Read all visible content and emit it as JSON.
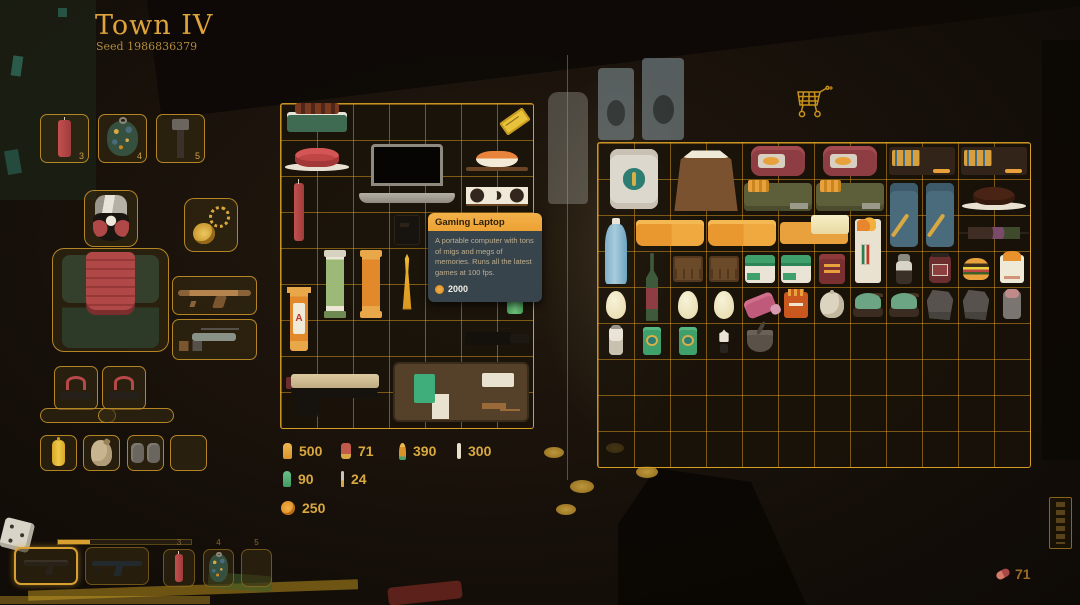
{
  "header": {
    "title": "Town IV",
    "seed": "Seed 1986836379"
  },
  "tooltip": {
    "title": "Gaming Laptop",
    "description": "A portable computer with tons of migs and megs of memories. Runs all the latest games at 100 fps.",
    "price": "2000"
  },
  "ammo": [
    {
      "icon": "pistol-round",
      "count": "500"
    },
    {
      "icon": "shotgun-shell",
      "count": "71"
    },
    {
      "icon": "rifle-round",
      "count": "390"
    },
    {
      "icon": "thin-round",
      "count": "300"
    },
    {
      "icon": "smg-green",
      "count": "90"
    },
    {
      "icon": "needle",
      "count": "24"
    }
  ],
  "coins": {
    "count": "250"
  },
  "pills": {
    "count": "71"
  },
  "quickslots": [
    {
      "num": "3",
      "item": "dynamite-stick",
      "visual": "dynamite"
    },
    {
      "num": "4",
      "item": "camo-grenade",
      "visual": "camo-grenade"
    },
    {
      "num": "5",
      "item": "metal-rod",
      "visual": "metal-rod"
    }
  ],
  "hotbar": {
    "slots": [
      {
        "num": "",
        "item": "pistol",
        "selected": true
      },
      {
        "num": "",
        "item": "smg",
        "selected": false
      },
      {
        "num": "3",
        "item": "dynamite-stick",
        "selected": false
      },
      {
        "num": "4",
        "item": "camo-grenade",
        "selected": false
      },
      {
        "num": "5",
        "item": "",
        "selected": false
      }
    ]
  },
  "equipment": {
    "head": "gas-mask",
    "torso": "samurai-armor",
    "feet": [
      "sandal",
      "sandal"
    ],
    "necklace": "gold-amulet",
    "weapons": [
      "wooden-smg",
      "pistol-with-parts"
    ],
    "utility": [
      "mustard-bottle",
      "leather-pouch",
      "grey-bags",
      "empty"
    ]
  },
  "inventory": {
    "grid": {
      "cols": 7,
      "rows": 9
    },
    "items": [
      {
        "name": "grilled-skewers",
        "visual": "bbq-tray",
        "col": 0,
        "row": 0,
        "w": 2,
        "h": 1
      },
      {
        "name": "event-ticket",
        "visual": "gold-ticket",
        "col": 6,
        "row": 0,
        "w": 1,
        "h": 1
      },
      {
        "name": "ham-on-plate",
        "visual": "ham-plate",
        "col": 0,
        "row": 1,
        "w": 2,
        "h": 1
      },
      {
        "name": "gaming-laptop",
        "visual": "laptop",
        "col": 2,
        "row": 1,
        "w": 3,
        "h": 2
      },
      {
        "name": "salmon-nigiri",
        "visual": "nigiri",
        "col": 5,
        "row": 1,
        "w": 2,
        "h": 1
      },
      {
        "name": "sushi-roll",
        "visual": "sushi-roll",
        "col": 5,
        "row": 2,
        "w": 2,
        "h": 1
      },
      {
        "name": "dynamite-stick",
        "visual": "dynamite",
        "col": 0,
        "row": 2,
        "w": 1,
        "h": 2
      },
      {
        "name": "radio",
        "visual": "radio-dark",
        "col": 3,
        "row": 3,
        "w": 1,
        "h": 1
      },
      {
        "name": "coin-roll-green",
        "visual": "scroll-green",
        "col": 1,
        "row": 4,
        "w": 1,
        "h": 2
      },
      {
        "name": "coin-roll-orange",
        "visual": "scroll-orange",
        "col": 2,
        "row": 4,
        "w": 1,
        "h": 2
      },
      {
        "name": "golden-trophy",
        "visual": "trophy-gold",
        "col": 3,
        "row": 4,
        "w": 1,
        "h": 2
      },
      {
        "name": "green-canister",
        "visual": "green-canister",
        "col": 6,
        "row": 4,
        "w": 1,
        "h": 2
      },
      {
        "name": "coin-roll-red",
        "visual": "scroll-red-a",
        "col": 0,
        "row": 5,
        "w": 1,
        "h": 2
      },
      {
        "name": "camera",
        "visual": "camera-black",
        "col": 5,
        "row": 6,
        "w": 2,
        "h": 1
      },
      {
        "name": "pistol",
        "visual": "pistol-tan",
        "col": 0,
        "row": 7,
        "w": 3,
        "h": 2
      },
      {
        "name": "toolkit-briefcase",
        "visual": "briefcase-kit",
        "col": 3,
        "row": 7,
        "w": 4,
        "h": 2
      }
    ]
  },
  "shop": {
    "grid": {
      "cols": 12,
      "rows": 9
    },
    "items": [
      {
        "name": "money-bundle",
        "visual": "money-stack",
        "col": 0,
        "row": 0,
        "w": 2,
        "h": 2
      },
      {
        "name": "flour-sack",
        "visual": "flour-sack",
        "col": 2,
        "row": 0,
        "w": 2,
        "h": 2
      },
      {
        "name": "canned-meat-1",
        "visual": "canned-meat",
        "col": 4,
        "row": 0,
        "w": 2,
        "h": 1
      },
      {
        "name": "canned-meat-2",
        "visual": "canned-meat",
        "col": 6,
        "row": 0,
        "w": 2,
        "h": 1
      },
      {
        "name": "match-crate-1",
        "visual": "matchbox-duo",
        "col": 8,
        "row": 0,
        "w": 2,
        "h": 1
      },
      {
        "name": "match-crate-2",
        "visual": "matchbox-duo",
        "col": 10,
        "row": 0,
        "w": 2,
        "h": 1
      },
      {
        "name": "ammo-box-1",
        "visual": "ammo-box-green",
        "col": 4,
        "row": 1,
        "w": 2,
        "h": 1
      },
      {
        "name": "ammo-box-2",
        "visual": "ammo-box-green",
        "col": 6,
        "row": 1,
        "w": 2,
        "h": 1
      },
      {
        "name": "ammo-pouch-1",
        "visual": "ammo-pouch-blue",
        "col": 8,
        "row": 1,
        "w": 1,
        "h": 2
      },
      {
        "name": "ammo-pouch-2",
        "visual": "ammo-pouch-blue",
        "col": 9,
        "row": 1,
        "w": 1,
        "h": 2
      },
      {
        "name": "chocolate-cake",
        "visual": "cake-plate",
        "col": 10,
        "row": 1,
        "w": 2,
        "h": 1
      },
      {
        "name": "water-jug",
        "visual": "water-bottle",
        "col": 0,
        "row": 2,
        "w": 1,
        "h": 2
      },
      {
        "name": "cheese-block-1",
        "visual": "butter-block",
        "col": 1,
        "row": 2,
        "w": 2,
        "h": 1
      },
      {
        "name": "cheese-block-2",
        "visual": "butter-block",
        "col": 3,
        "row": 2,
        "w": 2,
        "h": 1
      },
      {
        "name": "butter-stick",
        "visual": "butter-stick",
        "col": 5,
        "row": 2,
        "w": 2,
        "h": 1
      },
      {
        "name": "burning-letter",
        "visual": "burning-letter",
        "col": 7,
        "row": 2,
        "w": 1,
        "h": 2
      },
      {
        "name": "kebab-skewer",
        "visual": "kebab",
        "col": 10,
        "row": 2,
        "w": 2,
        "h": 1
      },
      {
        "name": "wine-bottle",
        "visual": "wine-bottle",
        "col": 1,
        "row": 3,
        "w": 1,
        "h": 2
      },
      {
        "name": "wooden-crate-1",
        "visual": "wood-crate",
        "col": 2,
        "row": 3,
        "w": 1,
        "h": 1
      },
      {
        "name": "wooden-crate-2",
        "visual": "wood-crate",
        "col": 3,
        "row": 3,
        "w": 1,
        "h": 1
      },
      {
        "name": "first-aid-kit-1",
        "visual": "aid-kit",
        "col": 4,
        "row": 3,
        "w": 1,
        "h": 1
      },
      {
        "name": "first-aid-kit-2",
        "visual": "aid-kit",
        "col": 5,
        "row": 3,
        "w": 1,
        "h": 1
      },
      {
        "name": "tobacco-pouch",
        "visual": "red-pouch",
        "col": 6,
        "row": 3,
        "w": 1,
        "h": 1
      },
      {
        "name": "pepper-shaker",
        "visual": "pepper-shaker",
        "col": 8,
        "row": 3,
        "w": 1,
        "h": 1
      },
      {
        "name": "jam-jar",
        "visual": "jam-jar",
        "col": 9,
        "row": 3,
        "w": 1,
        "h": 1
      },
      {
        "name": "burger",
        "visual": "burger",
        "col": 10,
        "row": 3,
        "w": 1,
        "h": 1
      },
      {
        "name": "fried-chicken-bag",
        "visual": "chicken-bag",
        "col": 11,
        "row": 3,
        "w": 1,
        "h": 1
      },
      {
        "name": "egg-1",
        "visual": "egg",
        "col": 0,
        "row": 4,
        "w": 1,
        "h": 1
      },
      {
        "name": "egg-2",
        "visual": "egg",
        "col": 2,
        "row": 4,
        "w": 1,
        "h": 1
      },
      {
        "name": "egg-3",
        "visual": "egg",
        "col": 3,
        "row": 4,
        "w": 1,
        "h": 1
      },
      {
        "name": "pill-pack",
        "visual": "meds-pink",
        "col": 4,
        "row": 4,
        "w": 1,
        "h": 1
      },
      {
        "name": "snack-box",
        "visual": "snack-box",
        "col": 5,
        "row": 4,
        "w": 1,
        "h": 1
      },
      {
        "name": "garlic",
        "visual": "garlic",
        "col": 6,
        "row": 4,
        "w": 1,
        "h": 1
      },
      {
        "name": "moss-clump-1",
        "visual": "moss-mound",
        "col": 7,
        "row": 4,
        "w": 1,
        "h": 1
      },
      {
        "name": "moss-clump-2",
        "visual": "moss-mound",
        "col": 8,
        "row": 4,
        "w": 1,
        "h": 1
      },
      {
        "name": "grey-cloth-1",
        "visual": "cloth-grey",
        "col": 9,
        "row": 4,
        "w": 1,
        "h": 1
      },
      {
        "name": "grey-cloth-2",
        "visual": "cloth-grey",
        "col": 10,
        "row": 4,
        "w": 1,
        "h": 1
      },
      {
        "name": "bandage-roll",
        "visual": "bandage-roll",
        "col": 11,
        "row": 4,
        "w": 1,
        "h": 1
      },
      {
        "name": "salt-shaker",
        "visual": "salt-shaker",
        "col": 0,
        "row": 5,
        "w": 1,
        "h": 1
      },
      {
        "name": "canned-fish-1",
        "visual": "green-can",
        "col": 1,
        "row": 5,
        "w": 1,
        "h": 1
      },
      {
        "name": "canned-fish-2",
        "visual": "green-can",
        "col": 2,
        "row": 5,
        "w": 1,
        "h": 1
      },
      {
        "name": "dropper-bottle",
        "visual": "dropper",
        "col": 3,
        "row": 5,
        "w": 1,
        "h": 1
      },
      {
        "name": "mortar-pestle",
        "visual": "mortar",
        "col": 4,
        "row": 5,
        "w": 1,
        "h": 1
      }
    ]
  }
}
